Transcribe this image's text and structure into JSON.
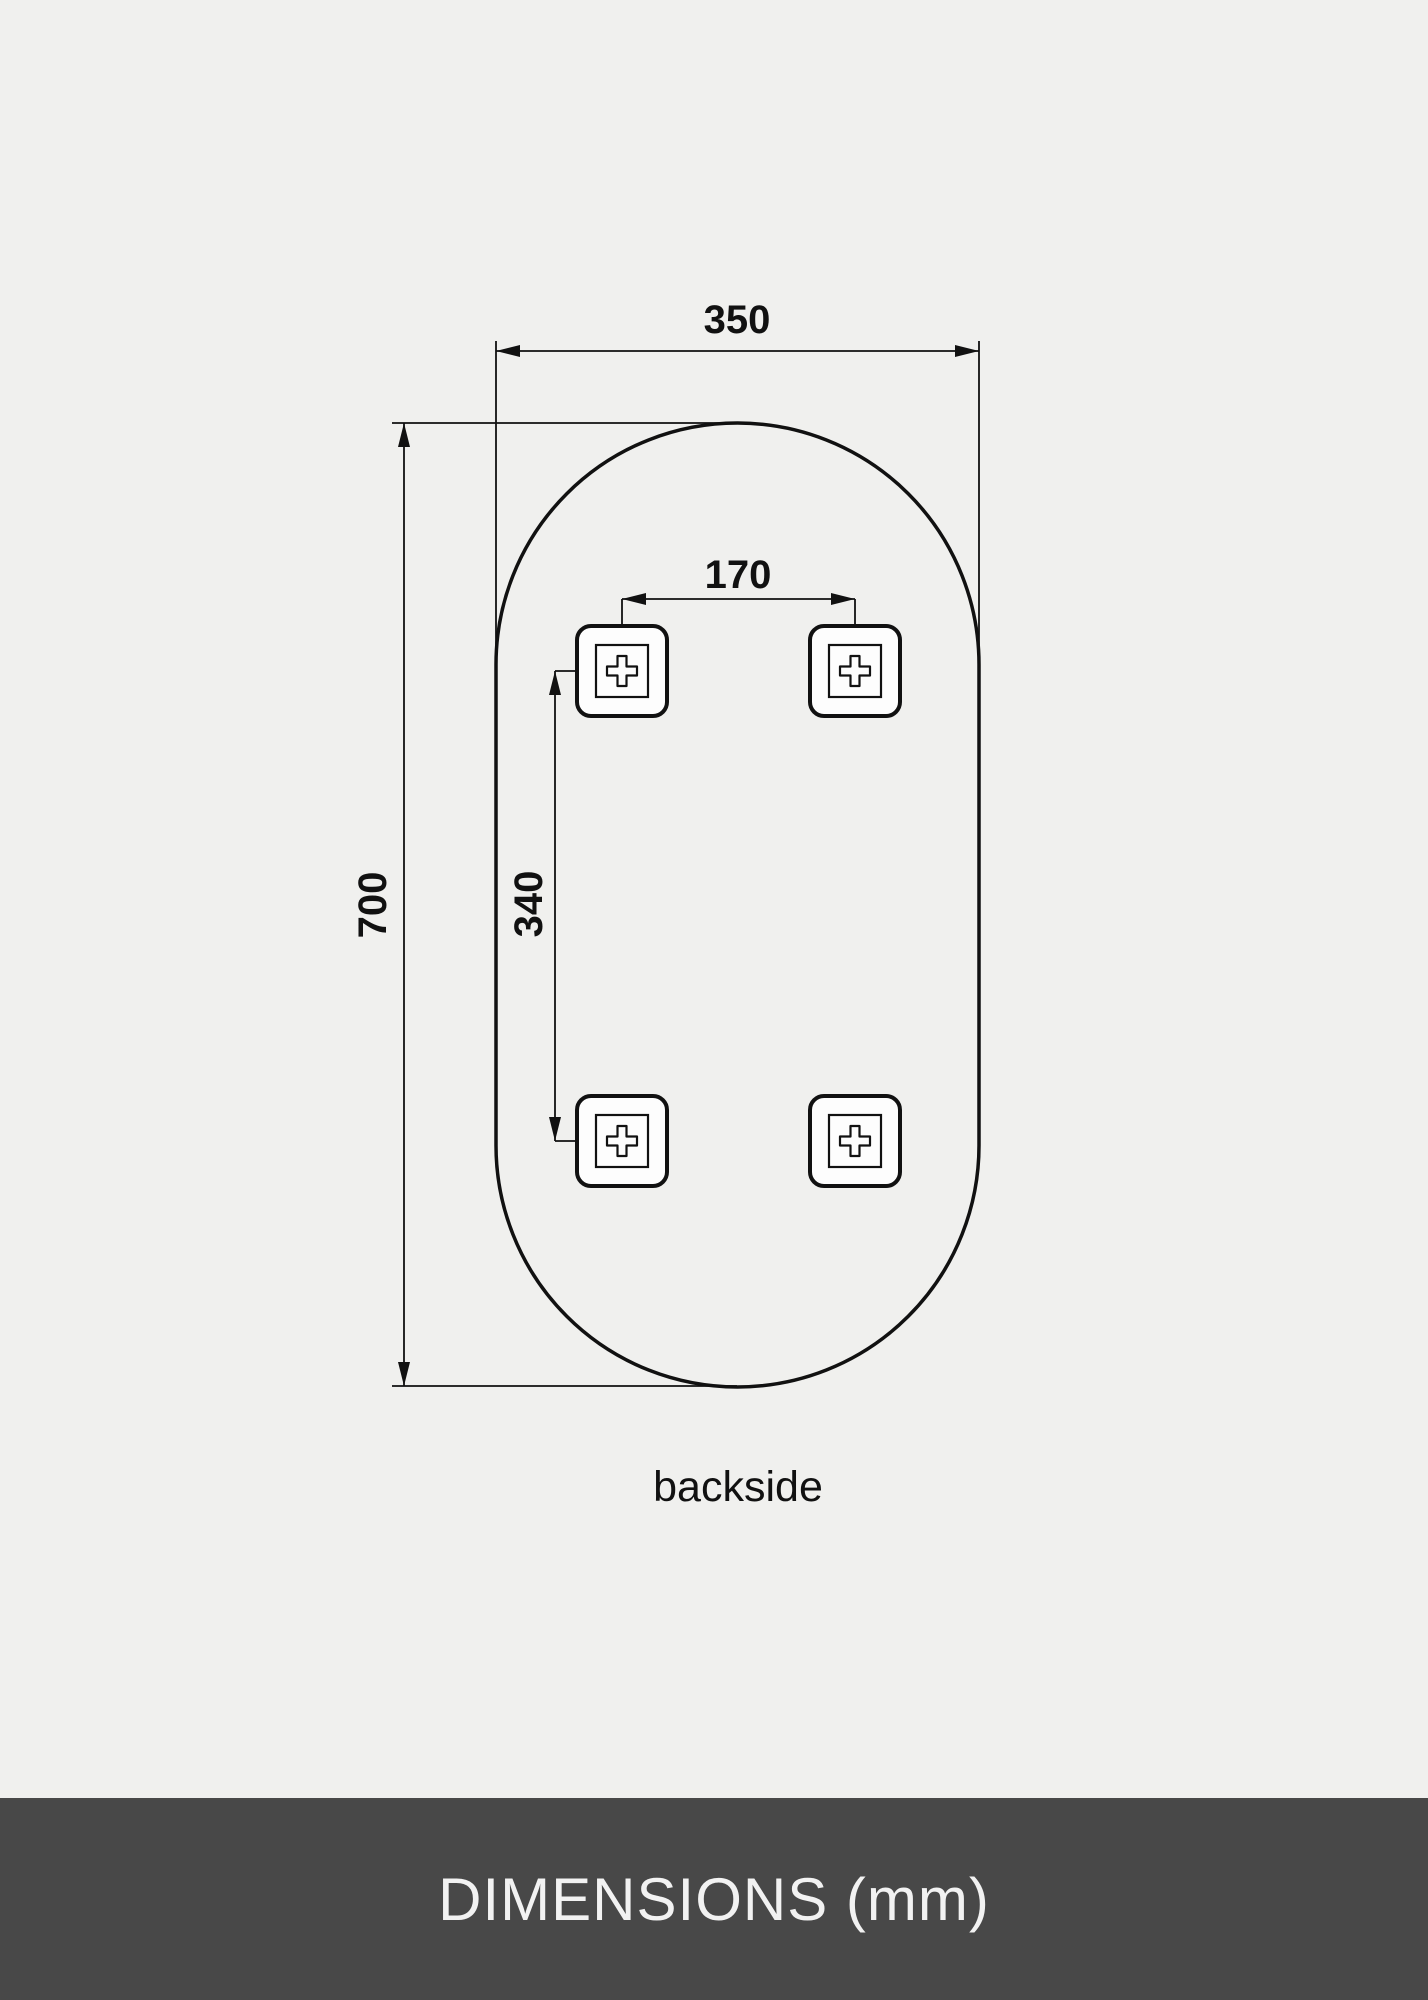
{
  "colors": {
    "background": "#f0f0ee",
    "line": "#111111",
    "bracket_fill": "#fdfdfd",
    "footer_background": "#484848",
    "footer_text": "#f2f2f2"
  },
  "diagram": {
    "width_label": "350",
    "height_label": "700",
    "hole_spacing_horizontal_label": "170",
    "hole_spacing_vertical_label": "340",
    "caption": "backside"
  },
  "footer": {
    "title": "DIMENSIONS (mm)"
  }
}
